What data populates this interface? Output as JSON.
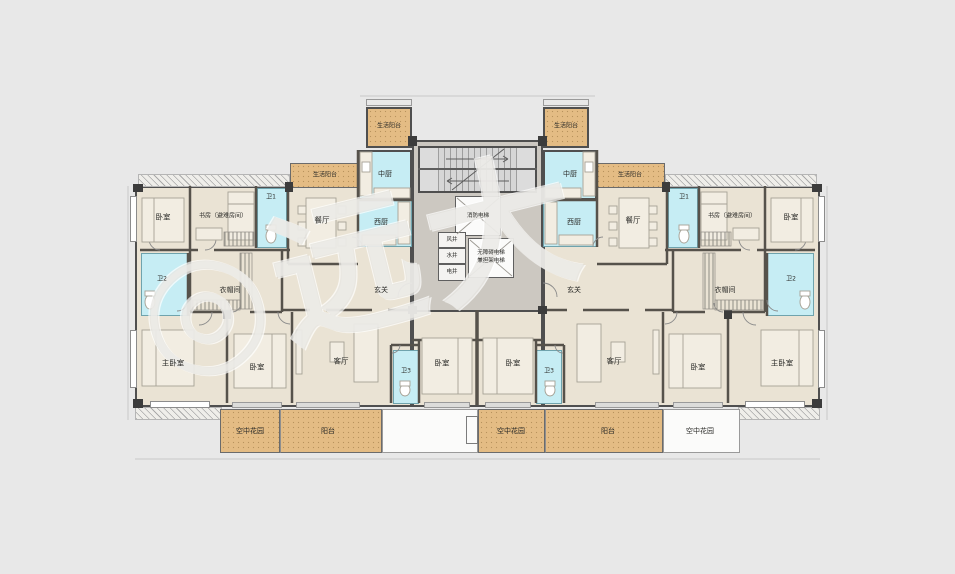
{
  "plan": {
    "watermark": "◎远大",
    "colors": {
      "background": "#e8e8e8",
      "floor": "#eae3d4",
      "wet_rooms": "#c6edf4",
      "balcony": "#e4bc84",
      "core": "#ccc8c1",
      "wall": "#4f4f4f",
      "stair": "#d6d6d6"
    },
    "core": {
      "elevator_fire": "消防电梯",
      "elevator_accessible_line1": "无障碍电梯",
      "elevator_accessible_line2": "兼担架电梯",
      "shaft_air": "风井",
      "shaft_water": "水井",
      "shaft_electric": "电井"
    },
    "left": {
      "bedroom_top": "卧室",
      "study": "书房（避难房间）",
      "bath1": "卫1",
      "dining": "餐厅",
      "life_balcony_upper": "生活阳台",
      "life_balcony_lower": "生活阳台",
      "kitchen_chinese": "中厨",
      "kitchen_western": "西厨",
      "bath2": "卫2",
      "cloakroom": "衣帽间",
      "foyer": "玄关",
      "master_bedroom": "主卧室",
      "bedroom2": "卧室",
      "living": "客厅",
      "bath3": "卫3",
      "bedroom3": "卧室"
    },
    "right": {
      "bedroom_top": "卧室",
      "study": "书房（避难房间）",
      "bath1": "卫1",
      "dining": "餐厅",
      "life_balcony_upper": "生活阳台",
      "life_balcony_lower": "生活阳台",
      "kitchen_chinese": "中厨",
      "kitchen_western": "西厨",
      "bath2": "卫2",
      "cloakroom": "衣帽间",
      "foyer": "玄关",
      "master_bedroom": "主卧室",
      "bedroom2": "卧室",
      "living": "客厅",
      "bath3": "卫3",
      "bedroom3": "卧室"
    },
    "bottom": {
      "sky_garden_left": "空中花园",
      "balcony_left": "阳台",
      "sky_garden_mid": "空中花园",
      "balcony_mid": "阳台",
      "sky_garden_right": "空中花园"
    }
  }
}
